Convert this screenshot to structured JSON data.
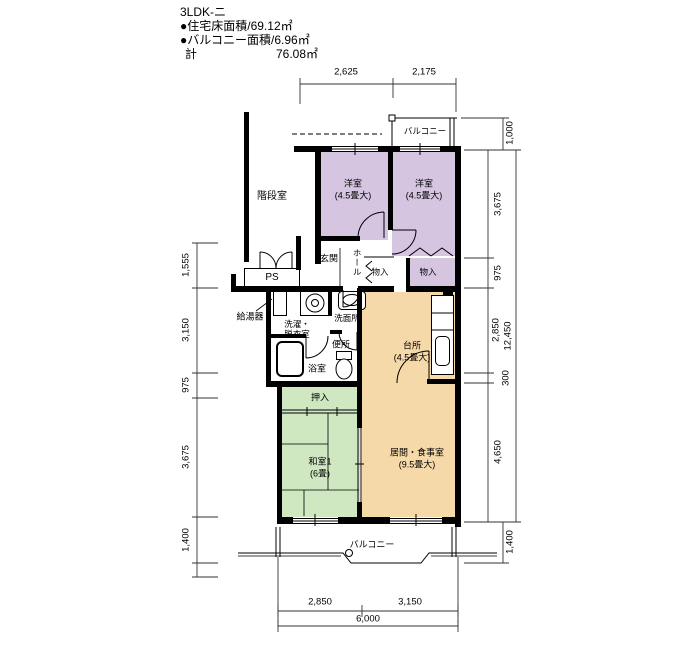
{
  "header": {
    "title": "3LDK-ニ",
    "floor_area_line": "●住宅床面積/69.12㎡",
    "balcony_area_line": "●バルコニー面積/6.96㎡",
    "total_label": "計",
    "total_value": "76.08㎡"
  },
  "dimensions": {
    "top": [
      "2,625",
      "2,175"
    ],
    "left": [
      "1,555",
      "3,150",
      "975",
      "3,675",
      "1,400"
    ],
    "right_inner": [
      "3,675",
      "975",
      "2,850",
      "300",
      "4,650"
    ],
    "right_outer": [
      "1,000",
      "12,450",
      "1,400"
    ],
    "bottom": [
      "2,850",
      "3,150",
      "6,000"
    ]
  },
  "rooms": {
    "stairwell": "階段室",
    "yoshitsu1": {
      "name": "洋室",
      "size": "(4.5畳大)"
    },
    "yoshitsu2": {
      "name": "洋室",
      "size": "(4.5畳大)"
    },
    "balcony_top": "バルコニー",
    "genkan": "玄関",
    "hall": "ホール",
    "ps": "PS",
    "monoire1": "物入",
    "monoire2": "物入",
    "water_heater": "給湯器",
    "laundry": {
      "line1": "洗濯・",
      "line2": "脱衣室"
    },
    "washroom": "洗面所",
    "toilet": "便所",
    "bath": "浴室",
    "kitchen": {
      "name": "台所",
      "size": "(4.5畳大)"
    },
    "oshiire": "押入",
    "washitsu": {
      "name": "和室1",
      "size": "(6畳)"
    },
    "living": {
      "name": "居間・食事室",
      "size": "(9.5畳大)"
    },
    "balcony_bottom": "バルコニー"
  },
  "colors": {
    "western_room": "#d5c5e1",
    "wood_floor": "#f6d9a8",
    "tatami_room": "#cfe8c2",
    "wall": "#000000"
  }
}
